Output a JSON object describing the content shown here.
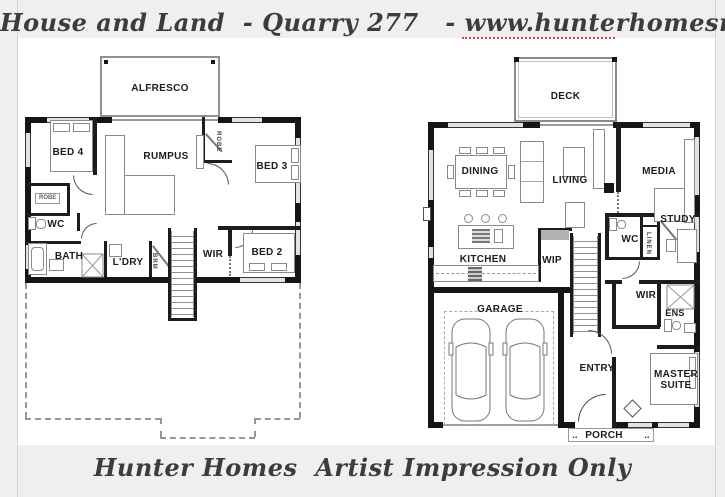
{
  "header": {
    "title": "House and Land  - Quarry 277   - www.hunterhomesnsw.com"
  },
  "footer": {
    "title": "Hunter Homes  Artist Impression Only"
  },
  "colors": {
    "background": "#f1efee",
    "sheet": "#ffffff",
    "wall": "#151515",
    "furniture_line": "#8a8a8a",
    "script_text": "#3c3c3e",
    "squiggle": "#cc4a41"
  },
  "plans": {
    "upper": {
      "rooms": {
        "alfresco": "ALFRESCO",
        "bed4": "BED 4",
        "rumpus": "RUMPUS",
        "bed3": "BED 3",
        "robe_bed3": "ROBE",
        "robe_bed4": "ROBE",
        "wc": "WC",
        "bath": "BATH",
        "ldry": "L'DRY",
        "brm": "BRM",
        "wir": "WIR",
        "bed2": "BED 2"
      }
    },
    "ground": {
      "rooms": {
        "deck": "DECK",
        "dining": "DINING",
        "living": "LIVING",
        "media": "MEDIA",
        "study": "STUDY",
        "wc": "WC",
        "linen": "LINEN",
        "kitchen": "KITCHEN",
        "wip": "WIP",
        "garage": "GARAGE",
        "entry": "ENTRY",
        "wir": "WIR",
        "ens": "ENS",
        "master": "MASTER SUITE",
        "porch": "PORCH",
        "porch_dots_left": "..",
        "porch_dots_right": ".."
      }
    }
  }
}
